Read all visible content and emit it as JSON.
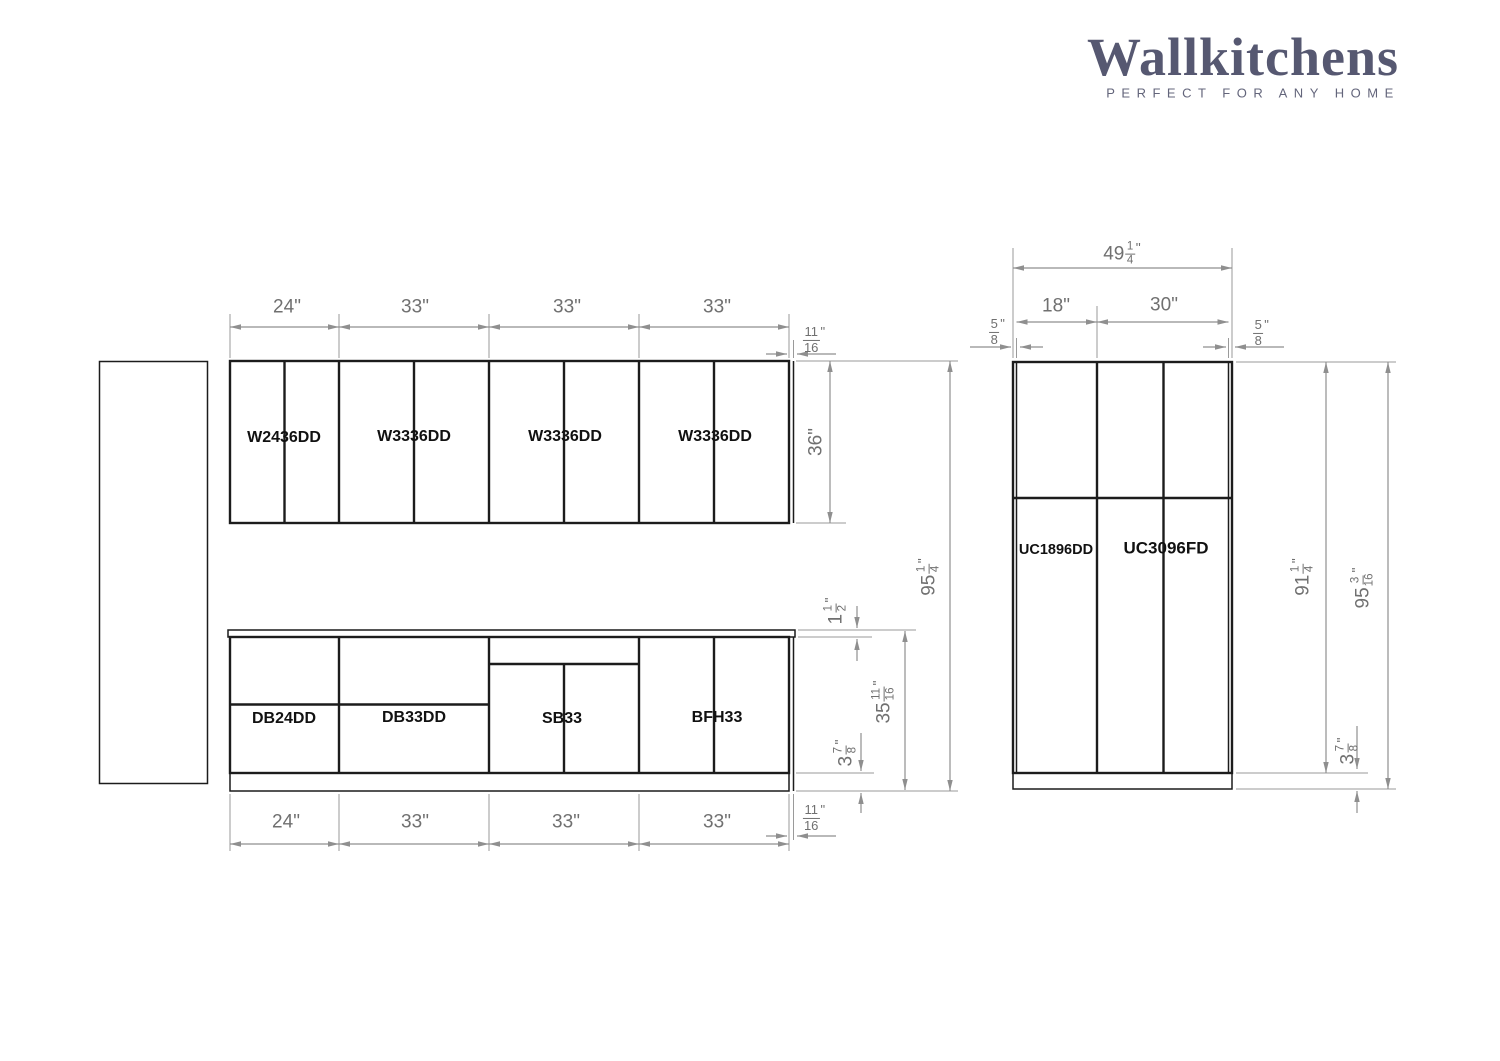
{
  "brand": {
    "name": "Wallkitchens",
    "tagline": "PERFECT FOR ANY HOME"
  },
  "left_elevation": {
    "wall_cabinets": [
      "W2436DD",
      "W3336DD",
      "W3336DD",
      "W3336DD"
    ],
    "base_cabinets": [
      "DB24DD",
      "DB33DD",
      "SB33",
      "BFH33"
    ],
    "top_widths": [
      "24\"",
      "33\"",
      "33\"",
      "33\""
    ],
    "bottom_widths": [
      "24\"",
      "33\"",
      "33\"",
      "33\""
    ],
    "wall_height": "36\"",
    "filler_top": {
      "num": "11",
      "den": "16",
      "unit": "\""
    },
    "filler_bottom": {
      "num": "11",
      "den": "16",
      "unit": "\""
    },
    "total_height": {
      "whole": "95",
      "num": "1",
      "den": "4",
      "unit": "\""
    },
    "counter_thickness": {
      "whole": "1",
      "num": "1",
      "den": "2",
      "unit": "\""
    },
    "base_height": {
      "whole": "35",
      "num": "11",
      "den": "16",
      "unit": "\""
    },
    "toe_kick_height": {
      "whole": "3",
      "num": "7",
      "den": "8",
      "unit": "\""
    }
  },
  "right_elevation": {
    "tall_cabinets": [
      "UC1896DD",
      "UC3096FD"
    ],
    "overall_width": {
      "whole": "49",
      "num": "1",
      "den": "4",
      "unit": "\""
    },
    "column_widths": [
      "18\"",
      "30\""
    ],
    "left_filler": {
      "num": "5",
      "den": "8",
      "unit": "\""
    },
    "right_filler": {
      "num": "5",
      "den": "8",
      "unit": "\""
    },
    "cabinet_height": {
      "whole": "91",
      "num": "1",
      "den": "4",
      "unit": "\""
    },
    "total_height": {
      "whole": "95",
      "num": "3",
      "den": "16",
      "unit": "\""
    },
    "toe_kick_height": {
      "whole": "3",
      "num": "7",
      "den": "8",
      "unit": "\""
    }
  },
  "colors": {
    "line": "#1c1c1c",
    "dim_line": "#8f8f8f",
    "dim_text": "#707070",
    "brand": "#565871"
  }
}
